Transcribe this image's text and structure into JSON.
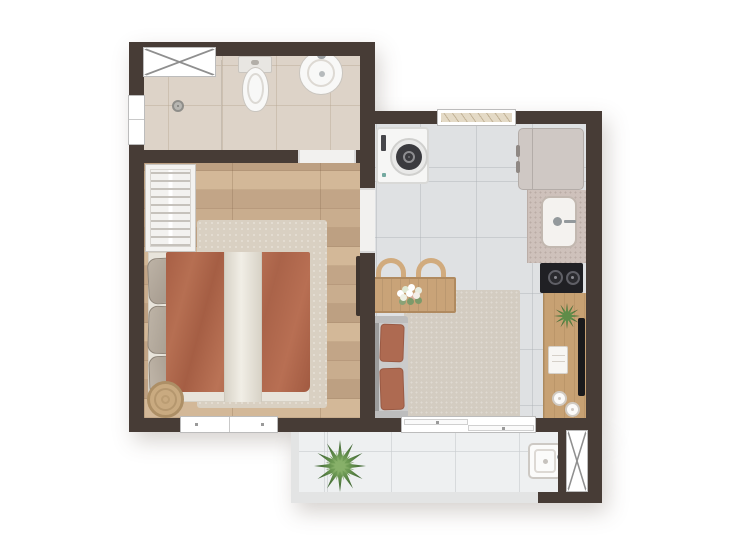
{
  "meta": {
    "description": "studio-apartment-floor-plan-top-view",
    "canvas_width": 744,
    "canvas_height": 550
  },
  "colors": {
    "bg": "#ffffff",
    "wall": "#473c36",
    "windowFill": "#ffffff",
    "windowLine": "#bcbcbc",
    "xLine": "#8f8f8f",
    "thresholdFill": "#f2f1ef",
    "bathFloor": "#ddd3c8",
    "bathLine": "#b4a48e66",
    "woodBase": "#c9ad8e",
    "woodDark": "#bda082",
    "woodDark2": "#c2a587",
    "woodLight": "#d3b898",
    "woodJoint": "#7c5e4240",
    "kitchenFloor": "#dfe1e3",
    "kitchenLine": "#a8adb266",
    "balconyFloor": "#eef0f1",
    "balconyLine": "#c8ccce99",
    "parapet": "#e3e4e4",
    "rugBedroom": "#d9d0c2",
    "rugLiving": "#d3ccc1",
    "blanket": "#b16a4f",
    "runnerLight": "#f1eee6",
    "runnerShade": "#d8d3c7",
    "pillowFill": "#b3a99c",
    "pillowLine": "#8f8579",
    "wardrobeFill": "#f3f2f0",
    "clothesLine": "#c6c2bc",
    "poufFill": "#c9aa80",
    "poufRing": "#ad8f66",
    "sofaSeat": "#cbcbcb",
    "sofaBack": "#9c9c9c",
    "sofaArm": "#bdbdbd",
    "cushion": "#ae6a51",
    "cushionLine": "#9a5a44",
    "tableWood": "#c9a378",
    "tableEdge": "#b08a5f",
    "chairWood": "#d1ab7e",
    "counterSpeckle": "#cec1bb",
    "speckDot": "#7f6a6340",
    "counterWood": "#c7a173",
    "counterGrain": "#a9855b66",
    "cooktop": "#202024",
    "burnerRing": "#5f5f66",
    "fridgeFill": "#cfc8c4",
    "fridgeLine": "#b3aca8",
    "washerFill": "#f6f6f5",
    "washerLine": "#d9d9d7",
    "drumDark": "#3a3a3e",
    "drumRing": "#8e8e91",
    "tv": "#1a1a1c",
    "plantDark": "#33582a",
    "plantLight": "#5f8c49",
    "fixtureFill": "#f8f8f7",
    "fixtureLine": "#c9c5bf",
    "doorLeaf": "#3f342e",
    "glassLine": "#c6bcb0"
  },
  "rooms": [
    {
      "id": "bathroom",
      "label": "bathroom"
    },
    {
      "id": "bedroom",
      "label": "bedroom"
    },
    {
      "id": "kitchen-living",
      "label": "kitchen-living"
    },
    {
      "id": "balcony",
      "label": "balcony"
    }
  ],
  "fixtures": [
    "bathroom-window",
    "shower-window",
    "shower-drain",
    "toilet",
    "washbasin",
    "wardrobe",
    "double-bed",
    "bed-pillows",
    "bedroom-rug",
    "pouf",
    "bedroom-window",
    "washing-machine",
    "fridge",
    "kitchen-sink",
    "cooktop",
    "kitchen-window",
    "dining-table",
    "dining-chairs",
    "sofa",
    "living-rug",
    "sideboard",
    "tv",
    "sliding-door",
    "balcony-plant",
    "laundry-tub",
    "balcony-window"
  ]
}
